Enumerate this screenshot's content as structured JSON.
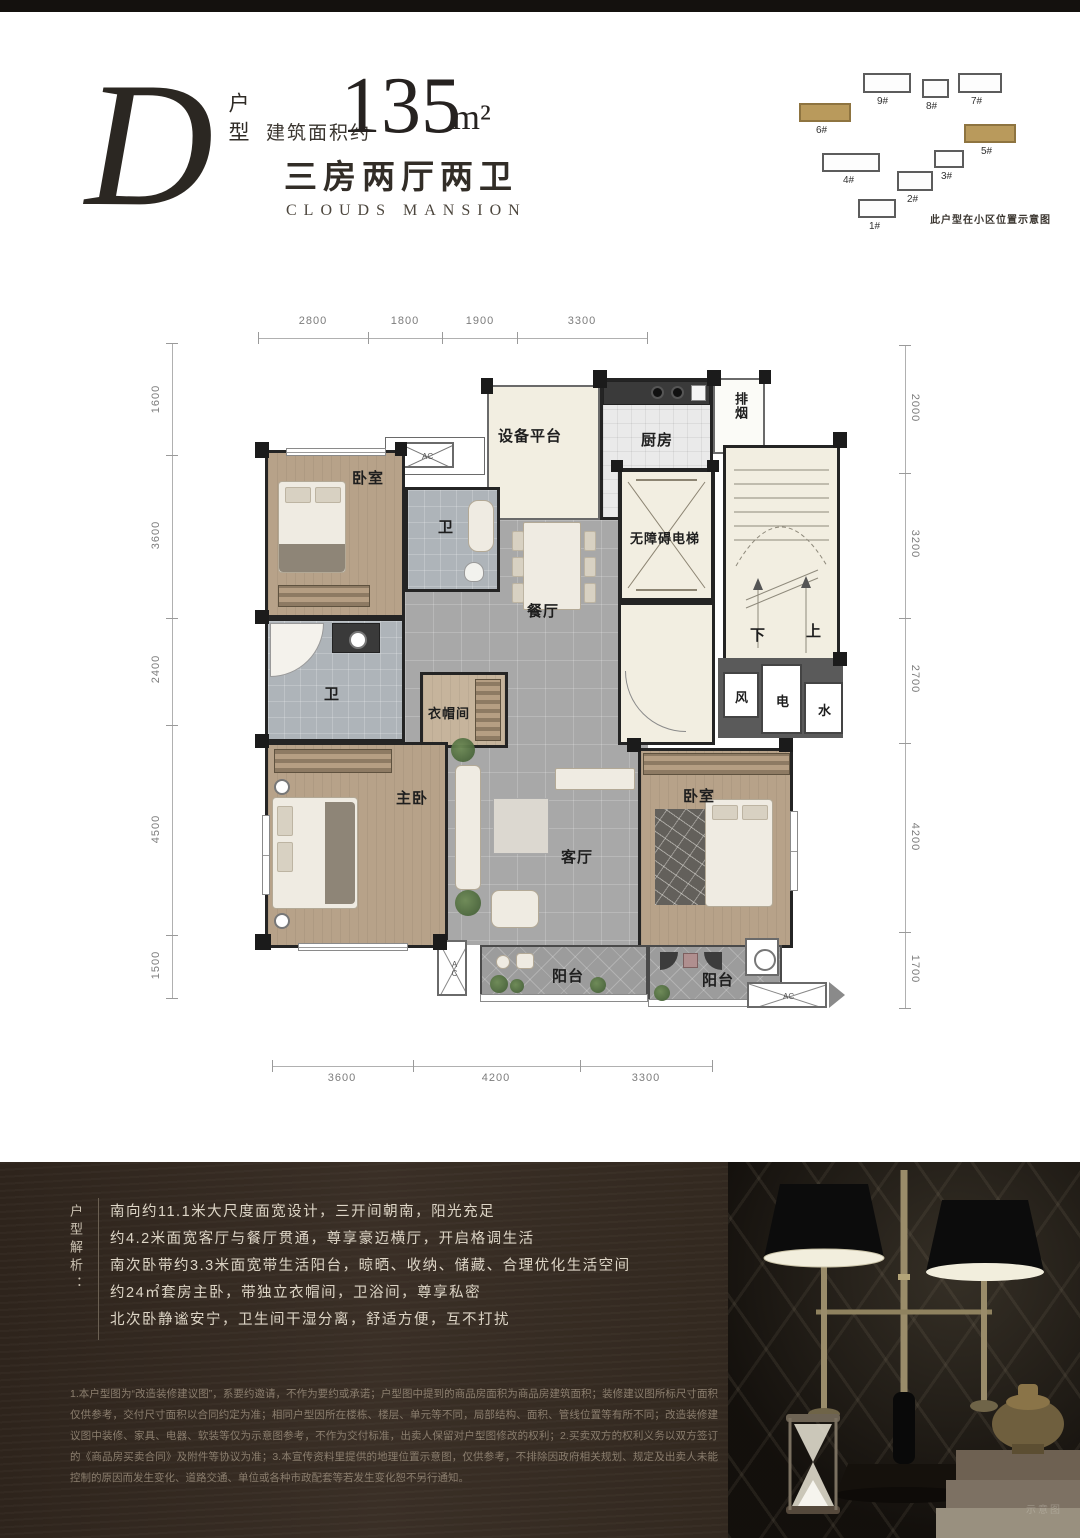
{
  "header": {
    "unit_letter": "D",
    "unit_type_label": "户型",
    "area_prefix": "建筑面积约",
    "area_value": "135",
    "area_unit": "m²",
    "layout_desc": "三房两厅两卫",
    "project_name": "CLOUDS MANSION"
  },
  "site_map": {
    "caption": "此户型在小区位置示意图",
    "highlight_color": "#b99a5c",
    "buildings": [
      "9#",
      "8#",
      "7#",
      "6#",
      "5#",
      "4#",
      "3#",
      "2#",
      "1#"
    ]
  },
  "plan": {
    "rooms": {
      "equipment_platform": "设备平台",
      "kitchen": "厨房",
      "exhaust": "排烟",
      "bedroom_north": "卧室",
      "bath_north": "卫",
      "dining": "餐厅",
      "elevator": "无障碍电梯",
      "stair_down": "下",
      "stair_up": "上",
      "shaft_wind": "风",
      "shaft_electric": "电",
      "shaft_water": "水",
      "bath_master": "卫",
      "cloakroom": "衣帽间",
      "master_bedroom": "主卧",
      "living": "客厅",
      "bedroom_south": "卧室",
      "balcony_south": "阳台",
      "balcony_southeast": "阳台",
      "ac_label": "AC"
    },
    "dims": {
      "top": [
        "2800",
        "1800",
        "1900",
        "3300"
      ],
      "bottom": [
        "3600",
        "4200",
        "3300"
      ],
      "left": [
        "1600",
        "3600",
        "2400",
        "4500",
        "1500"
      ],
      "right": [
        "2000",
        "3200",
        "2700",
        "4200",
        "1700"
      ]
    }
  },
  "analysis": {
    "title": "户型解析：",
    "lines": [
      "南向约11.1米大尺度面宽设计，三开间朝南，阳光充足",
      "约4.2米面宽客厅与餐厅贯通，尊享豪迈横厅，开启格调生活",
      "南次卧带约3.3米面宽带生活阳台，晾晒、收纳、储藏、合理优化生活空间",
      "约24㎡套房主卧，带独立衣帽间，卫浴间，尊享私密",
      "北次卧静谧安宁，卫生间干湿分离，舒适方便，互不打扰"
    ]
  },
  "disclaimer": "1.本户型图为“改造装修建议图”，系要约邀请，不作为要约或承诺；户型图中提到的商品房面积为商品房建筑面积；装修建议图所标尺寸面积仅供参考，交付尺寸面积以合同约定为准；相同户型因所在楼栋、楼层、单元等不同，局部结构、面积、管线位置等有所不同；改造装修建议图中装修、家具、电器、软装等仅为示意图参考，不作为交付标准，出卖人保留对户型图修改的权利；2.买卖双方的权利义务以双方签订的《商品房买卖合同》及附件等协议为准；3.本宣传资料里提供的地理位置示意图，仅供参考，不排除因政府相关规划、规定及出卖人未能控制的原因而发生变化、道路交通、单位或各种市政配套等若发生变化恕不另行通知。",
  "photo": {
    "watermark": "示意图"
  }
}
